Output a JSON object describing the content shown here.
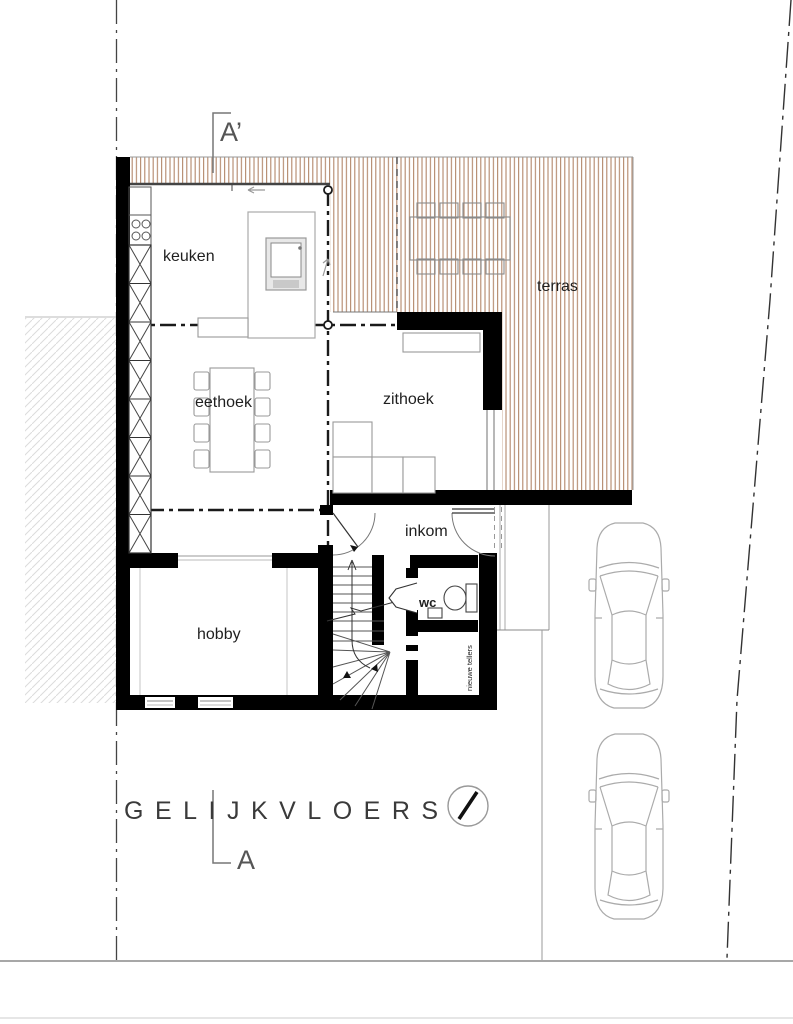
{
  "drawing": {
    "floor_title": "GELIJKVLOERS",
    "rooms": {
      "keuken": "keuken",
      "eethoek": "eethoek",
      "zithoek": "zithoek",
      "terras": "terras",
      "inkom": "inkom",
      "wc": "wc",
      "hobby": "hobby",
      "meters_label": "nieuwe tellers"
    },
    "section": {
      "top_marker": "A’",
      "bottom_marker": "A"
    },
    "icons": {
      "north_indicator": "north-arrow"
    },
    "colors": {
      "deck_stripe": "#b3876a",
      "wall_black": "#000000",
      "furniture_gray": "#999999",
      "car_gray": "#ababab",
      "boundary_gray": "#444444",
      "label_text": "#222222"
    }
  }
}
